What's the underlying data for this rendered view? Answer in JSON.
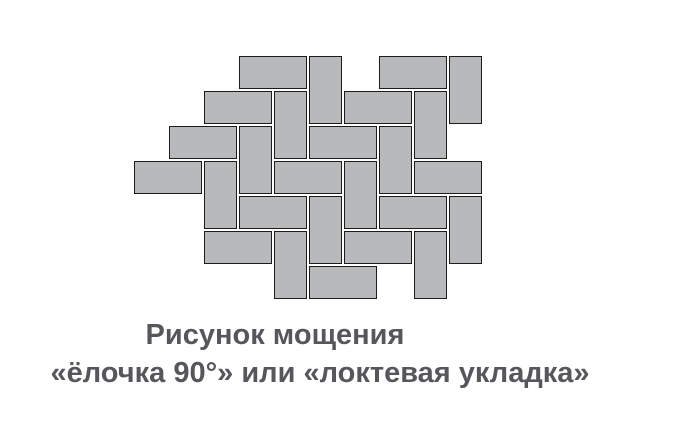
{
  "caption": {
    "line1": "Рисунок мощения",
    "line2": "«ёлочка 90°» или «локтевая укладка»"
  },
  "colors": {
    "background": "#ffffff",
    "brick_fill": "#b8b9bb",
    "brick_border": "#1c1c1c",
    "caption_text": "#56575b"
  },
  "pattern": {
    "name": "herringbone-90-paving",
    "unit_px": 35,
    "origin": {
      "x": 134,
      "y": 56
    },
    "brick_h_cells": 2,
    "brick_v_cells": 2,
    "bricks": [
      {
        "c": 3,
        "r": 0,
        "o": "H"
      },
      {
        "c": 5,
        "r": 0,
        "o": "V"
      },
      {
        "c": 7,
        "r": 0,
        "o": "H"
      },
      {
        "c": 9,
        "r": 0,
        "o": "V"
      },
      {
        "c": 2,
        "r": 1,
        "o": "H"
      },
      {
        "c": 4,
        "r": 1,
        "o": "V"
      },
      {
        "c": 6,
        "r": 1,
        "o": "H"
      },
      {
        "c": 8,
        "r": 1,
        "o": "V"
      },
      {
        "c": 1,
        "r": 2,
        "o": "H"
      },
      {
        "c": 3,
        "r": 2,
        "o": "V"
      },
      {
        "c": 5,
        "r": 2,
        "o": "H"
      },
      {
        "c": 7,
        "r": 2,
        "o": "V"
      },
      {
        "c": 0,
        "r": 3,
        "o": "H"
      },
      {
        "c": 2,
        "r": 3,
        "o": "V"
      },
      {
        "c": 4,
        "r": 3,
        "o": "H"
      },
      {
        "c": 6,
        "r": 3,
        "o": "V"
      },
      {
        "c": 8,
        "r": 3,
        "o": "H"
      },
      {
        "c": 3,
        "r": 4,
        "o": "H"
      },
      {
        "c": 5,
        "r": 4,
        "o": "V"
      },
      {
        "c": 7,
        "r": 4,
        "o": "H"
      },
      {
        "c": 9,
        "r": 4,
        "o": "V"
      },
      {
        "c": 2,
        "r": 5,
        "o": "H"
      },
      {
        "c": 4,
        "r": 5,
        "o": "V"
      },
      {
        "c": 6,
        "r": 5,
        "o": "H"
      },
      {
        "c": 8,
        "r": 5,
        "o": "V"
      },
      {
        "c": 5,
        "r": 6,
        "o": "H"
      }
    ]
  }
}
